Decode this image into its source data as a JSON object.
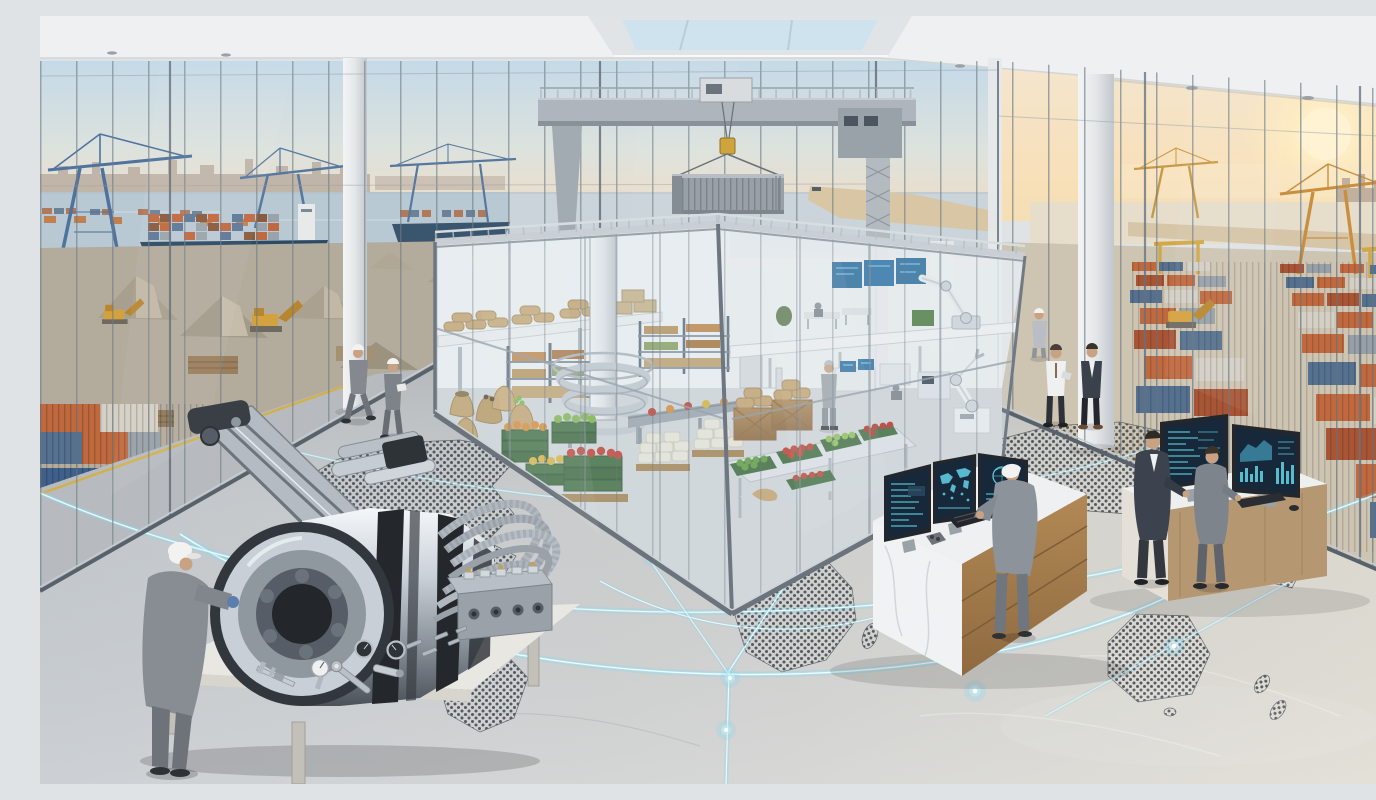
{
  "scene": {
    "title": "Global logistics hub overlooking a container port at sunrise",
    "description": "Photorealistic illustration: a bright glass-walled logistics control hall at golden hour. Through floor-to-ceiling windows a container port is visible with ships, blue and yellow gantry cranes, gravel stockpiles and stacked containers. Inside, an indoor gantry crane lifts a gray shipping container above a glass-walled micro-warehouse stocked with produce crates, burlap sacks, pallet racks, a spiral conveyor and robotic arms. Workers in gray coveralls and businessmen monitor dashboards on multi-screen desks while a technician inspects a chrome engine with braided hoses on a white workbench. The polished concrete floor carries a dotted world map crossed by glowing light-blue trade-route arcs with bright nodes.",
    "time_of_day": "sunrise golden light",
    "style": "photorealistic 3D render"
  },
  "palette": {
    "sky_cool": "#c3d9e8",
    "sky_warm": "#f6e3c6",
    "sun_glow": "#fff3d4",
    "water": "#b9c9d3",
    "floor_cool": "#c4c9ce",
    "floor_warm": "#e0dcd2",
    "glow_accent": "#8fe0f5",
    "steel": "#aeb5bc",
    "container_gray": "#98a0a8",
    "container_orange": "#c0693f",
    "container_rust": "#a85536",
    "container_blue": "#55718f",
    "crane_blue": "#4f739e",
    "crane_yellow": "#cf9c42",
    "hook_yellow": "#d0a43c",
    "produce_red": "#c23d30",
    "produce_green": "#7fb347",
    "produce_orange": "#d98934",
    "produce_yellow": "#d9b23c",
    "crate_green": "#3d6b3a",
    "burlap": "#c3a26c",
    "wood": "#a9835a",
    "marble": "#f1f2f4",
    "screen_bg": "#16283a",
    "screen_cyan": "#63d7e6",
    "suit_dark": "#3c4350",
    "coverall_gray": "#888d94",
    "helmet_white": "#f2f2f0"
  },
  "window_left": {
    "label": "port view through west glass wall",
    "elements": [
      "distant city skyline",
      "two blue ship-to-shore cranes",
      "loaded container ship",
      "second ship with crane",
      "harbor water",
      "gravel stockpiles",
      "yellow excavators",
      "timber and cargo stacks",
      "stacked orange and blue containers",
      "access road with yellow line"
    ]
  },
  "window_right": {
    "label": "container yard through east glass wall",
    "elements": [
      "low sun with warm haze",
      "city skyline silhouette",
      "water channel",
      "yellow gantry cranes",
      "orange quay crane",
      "rows of stacked containers",
      "yellow excavator"
    ]
  },
  "ceiling": {
    "label": "white ceiling with recessed skylight",
    "elements": [
      "skylight glazing",
      "downlights",
      "white columns"
    ]
  },
  "indoor_crane": {
    "label": "indoor gantry crane",
    "load": "gray corrugated shipping container",
    "hook": "yellow hoist block",
    "structure": "gray portal beam with trolley and lattice mast"
  },
  "enclosure": {
    "label": "glass-walled micro-warehouse",
    "contents": [
      "mezzanine with burlap sack stacks",
      "pallet racking with goods",
      "spiral conveyor around steel column",
      "belt conveyor with produce trays",
      "white AGV robot",
      "burlap sacks",
      "green produce crates with oranges, apples, tomatoes",
      "white sack pallets",
      "wooden crates with sacks",
      "stainless produce table",
      "processing machines with blue screens",
      "two white robotic arms",
      "supervisor in gray"
    ]
  },
  "floor": {
    "label": "polished concrete floor",
    "map": "dotted world map (Americas, Africa, Eurasia, Australia, New Zealand)",
    "network": "glowing light-blue trade-route arcs",
    "glow_nodes": 7
  },
  "workstations": {
    "center_desk": {
      "label": "marble and wood control desk",
      "monitors": 3,
      "monitor_content": [
        "data tables",
        "world map dashboard",
        "globe with charts"
      ],
      "peripherals": [
        "keyboard",
        "tool pouch"
      ],
      "operator": "worker in gray coveralls with white cap"
    },
    "right_desk": {
      "label": "light wood analytics desk",
      "monitors": 2,
      "monitor_content": [
        "text log dashboard",
        "area and bar charts"
      ],
      "peripherals": [
        "keyboard",
        "mouse"
      ],
      "staff": [
        "man in dark suit",
        "man in gray jacket"
      ]
    }
  },
  "engine_bench": {
    "label": "white workbench with chrome engine",
    "elements": [
      "chrome cylindrical engine with black bands",
      "articulated chrome boom arm",
      "braided metal hoses",
      "hydraulic manifold block",
      "caliper",
      "dial indicator",
      "wrench",
      "pressure gauges",
      "micrometer",
      "bolts and pins"
    ],
    "technician": "worker in gray coveralls, white cap, blue gloves"
  },
  "people": [
    {
      "id": "technician-engine",
      "role": "inspecting engine",
      "location": "front left"
    },
    {
      "id": "worker-walking-1",
      "role": "walking with hard hat",
      "location": "mid left"
    },
    {
      "id": "worker-walking-2",
      "role": "holding clipboard",
      "location": "mid left"
    },
    {
      "id": "supervisor-enclosure",
      "role": "overseeing warehouse",
      "location": "inside enclosure"
    },
    {
      "id": "operator-center-desk",
      "role": "typing at dashboards",
      "location": "center right"
    },
    {
      "id": "businessman-shirt",
      "role": "discussing with tablet",
      "location": "right of enclosure"
    },
    {
      "id": "businessman-suit",
      "role": "discussing",
      "location": "right of enclosure"
    },
    {
      "id": "worker-window",
      "role": "standing by glass",
      "location": "right background"
    },
    {
      "id": "analyst-suit",
      "role": "reviewing right desk",
      "location": "far right"
    },
    {
      "id": "analyst-gray",
      "role": "reviewing right desk",
      "location": "far right"
    }
  ]
}
